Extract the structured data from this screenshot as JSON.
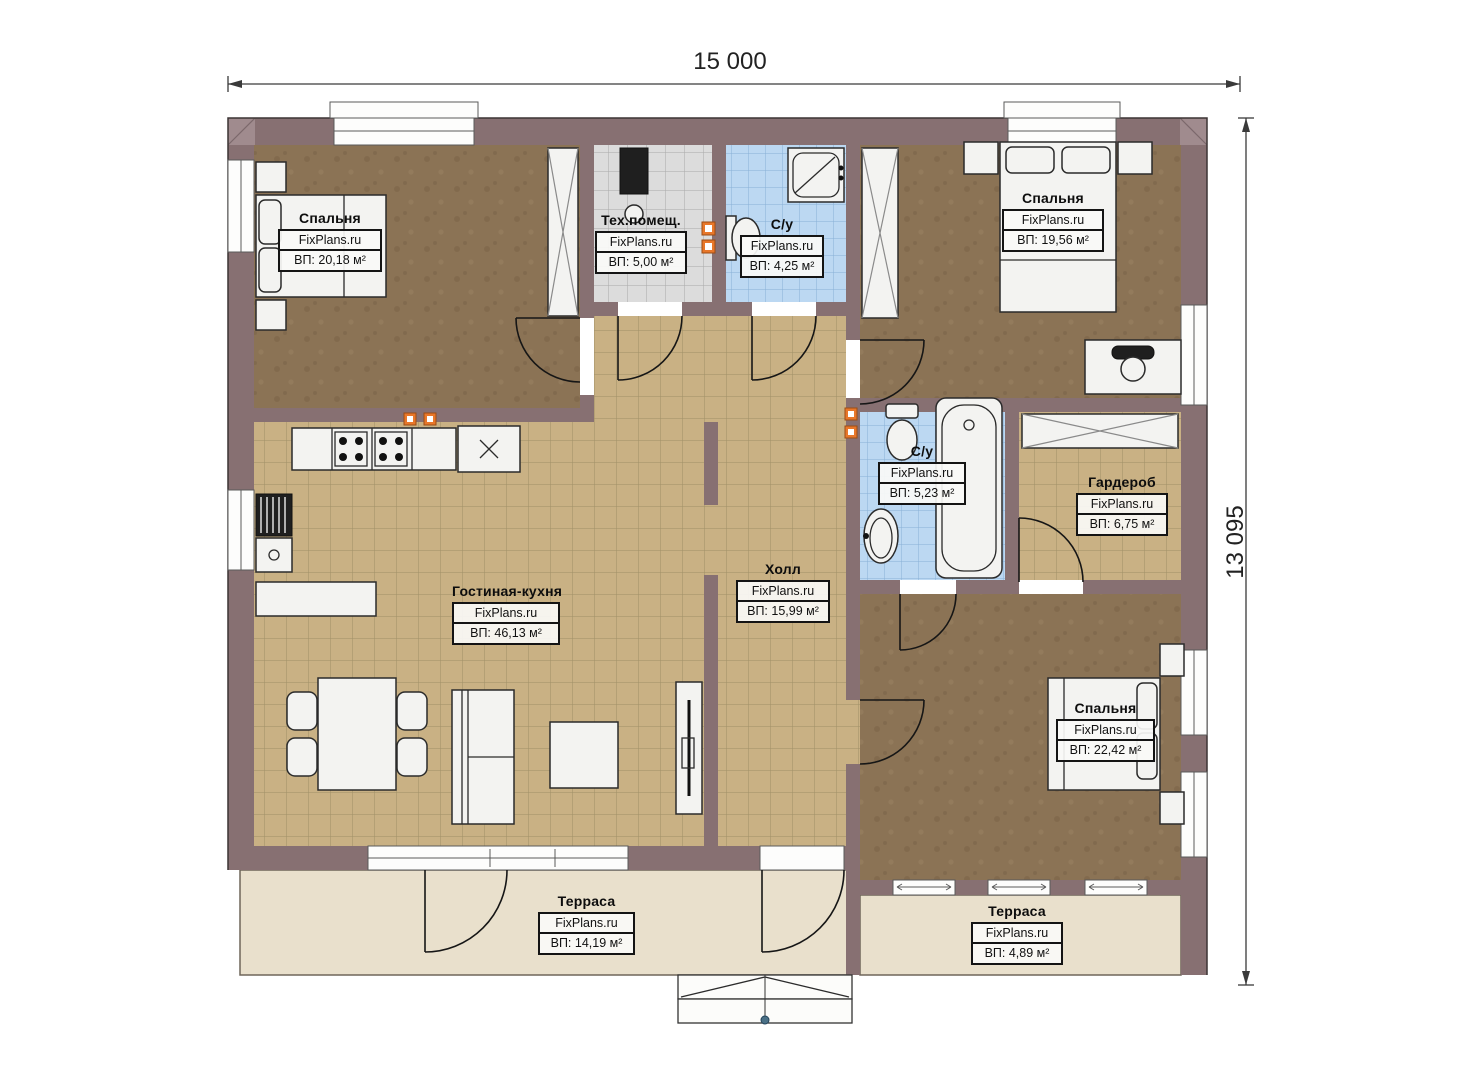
{
  "brand": "FixPlans.ru",
  "dimensions": {
    "width": "15 000",
    "height": "13 095"
  },
  "rooms": [
    {
      "id": "bedroom-1",
      "name": "Спальня",
      "brand": "FixPlans.ru",
      "area": "ВП: 20,18 м²"
    },
    {
      "id": "tech-room",
      "name": "Тех.помещ.",
      "brand": "FixPlans.ru",
      "area": "ВП: 5,00 м²"
    },
    {
      "id": "bathroom-1",
      "name": "С/у",
      "brand": "FixPlans.ru",
      "area": "ВП: 4,25 м²"
    },
    {
      "id": "bedroom-2",
      "name": "Спальня",
      "brand": "FixPlans.ru",
      "area": "ВП: 19,56 м²"
    },
    {
      "id": "living-kitchen",
      "name": "Гостиная-кухня",
      "brand": "FixPlans.ru",
      "area": "ВП: 46,13 м²"
    },
    {
      "id": "hall",
      "name": "Холл",
      "brand": "FixPlans.ru",
      "area": "ВП: 15,99 м²"
    },
    {
      "id": "bathroom-2",
      "name": "С/у",
      "brand": "FixPlans.ru",
      "area": "ВП: 5,23 м²"
    },
    {
      "id": "wardrobe",
      "name": "Гардероб",
      "brand": "FixPlans.ru",
      "area": "ВП: 6,75 м²"
    },
    {
      "id": "bedroom-3",
      "name": "Спальня",
      "brand": "FixPlans.ru",
      "area": "ВП: 22,42 м²"
    },
    {
      "id": "terrace-1",
      "name": "Терраса",
      "brand": "FixPlans.ru",
      "area": "ВП: 14,19 м²"
    },
    {
      "id": "terrace-2",
      "name": "Терраса",
      "brand": "FixPlans.ru",
      "area": "ВП: 4,89 м²"
    }
  ],
  "colors": {
    "wall": "#877072",
    "wallCorner": "#a08b8e",
    "tileTan": "#c9b184",
    "tileGray": "#dcdcdc",
    "tileBlue": "#bcd8f2",
    "floorBedroom": "#8b7355",
    "terrace": "#e9e0cc",
    "furniture": "#f3f3f1",
    "accentSocket": "#e8772a",
    "dimension": "#3a3a3a"
  }
}
